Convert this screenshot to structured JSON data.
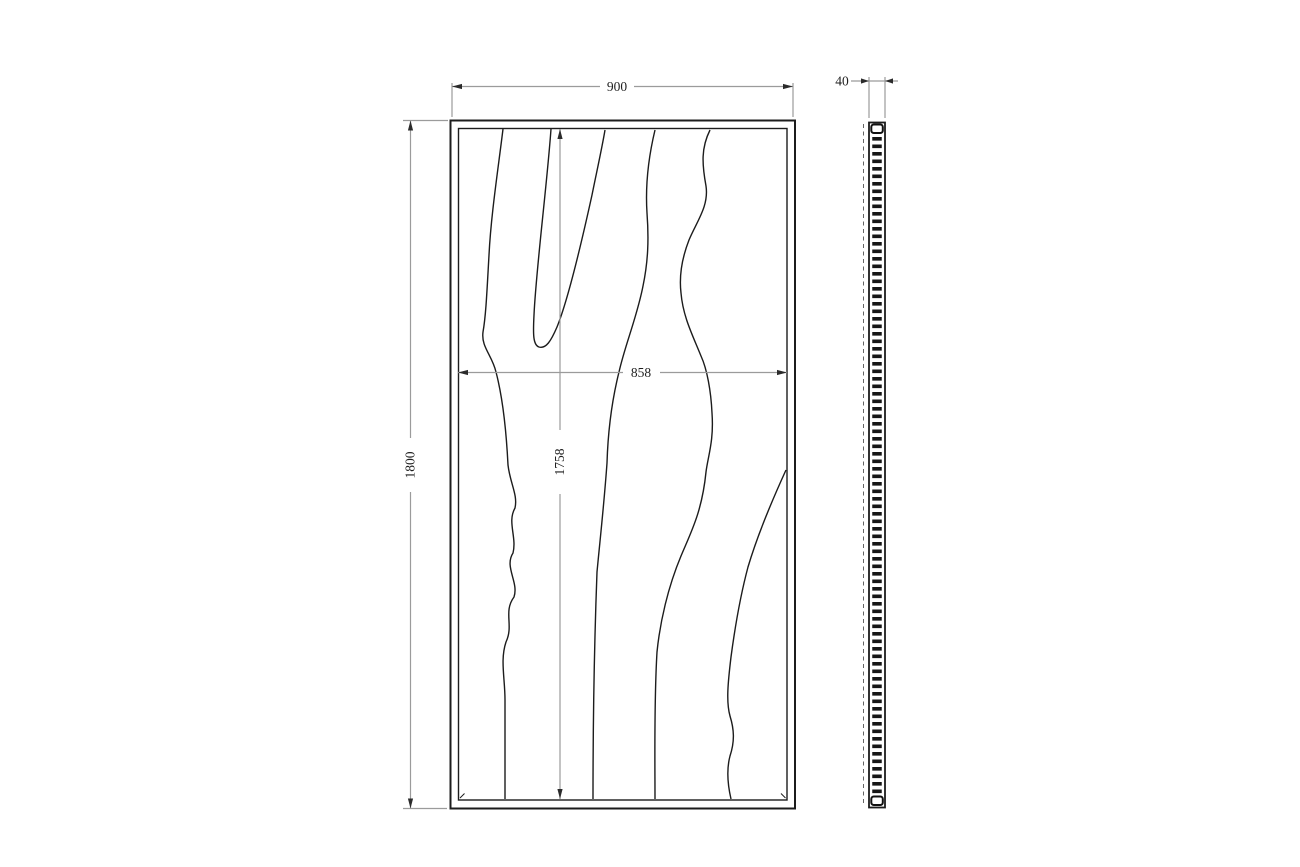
{
  "drawing": {
    "kind": "technical-drawing",
    "subject": "framed wood-grain wall panel, front elevation and side profile",
    "background": "#ffffff",
    "views": {
      "front": {
        "label": "front-view",
        "grain_line_count": 5
      },
      "side": {
        "label": "side-profile-view",
        "has_hatch": true
      }
    },
    "dims": {
      "overall_width": {
        "value": "900",
        "orientation": "horizontal",
        "position": "top-of-front-view"
      },
      "overall_height": {
        "value": "1800",
        "orientation": "vertical",
        "position": "left-of-front-view"
      },
      "face_width": {
        "value": "858",
        "orientation": "horizontal",
        "position": "inside-front-view"
      },
      "face_height": {
        "value": "1758",
        "orientation": "vertical",
        "position": "inside-front-view"
      },
      "depth": {
        "value": "40",
        "orientation": "horizontal",
        "position": "top-of-side-view"
      }
    },
    "colors": {
      "model_line": "#1c1c1c",
      "dimension_line": "#9b9b9b",
      "arrow": "#2b2b2b",
      "text": "#1f1f1f",
      "background": "#ffffff"
    }
  }
}
